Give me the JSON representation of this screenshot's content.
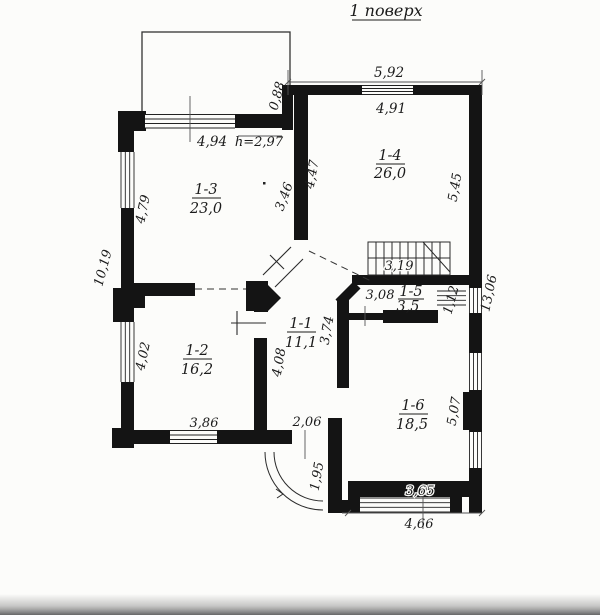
{
  "title": "1 поверх",
  "colors": {
    "ink": "#1b1b1b",
    "paper": "#fcfcfa"
  },
  "rooms": {
    "r1": {
      "id": "1-1",
      "area": "11,1"
    },
    "r2": {
      "id": "1-2",
      "area": "16,2"
    },
    "r3": {
      "id": "1-3",
      "area": "23,0"
    },
    "r4": {
      "id": "1-4",
      "area": "26,0"
    },
    "r5": {
      "id": "1-5",
      "area": "3,5"
    },
    "r6": {
      "id": "1-6",
      "area": "18,5"
    }
  },
  "dims": {
    "top_outer": "5,92",
    "top_inner": "4,91",
    "jog": "0,88",
    "r3_top": "4,94",
    "ceiling_note": "h=2,97",
    "r3_left": "4,79",
    "r3_right": "3,46",
    "r4_left": "4,47",
    "r4_right": "5,45",
    "left_total": "10,19",
    "right_total": "13,06",
    "stairs": "3,19",
    "r5_top": "3,08",
    "r5_opening": "1,12",
    "r2_left": "4,02",
    "r2_bottom": "3,86",
    "hall_left": "4,08",
    "hall_right": "3,74",
    "entry": "2,06",
    "porch": "1,95",
    "r6_right": "5,07",
    "r6_bottom": "3,65",
    "bottom_outer": "4,66"
  }
}
